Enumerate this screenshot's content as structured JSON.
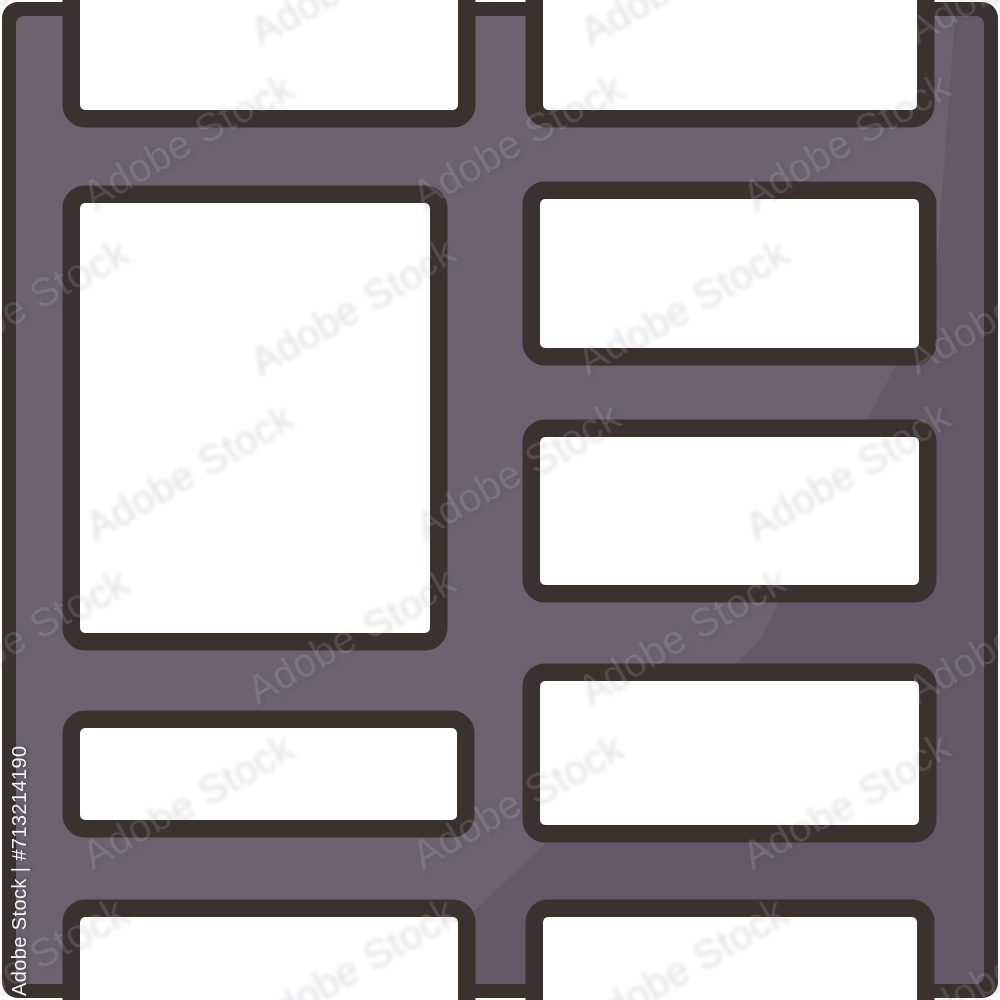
{
  "image": {
    "kind": "stock-icon-preview",
    "subject": "shelf / room divider flat icon with colored outline",
    "width": 1000,
    "height": 1000
  },
  "icon": {
    "colors": {
      "background": "#ffffff",
      "outline": "#3a322f",
      "fill": "#6b6470",
      "shade": "rgba(22,12,36,0.10)",
      "opening": "#ffffff"
    },
    "stroke_width": 17.5,
    "corner_radius": 14,
    "frame": {
      "x": 2,
      "y": 2,
      "w": 996,
      "h": 996,
      "rx": 16
    },
    "inner": {
      "x": 16,
      "y": 16,
      "w": 968,
      "h": 968,
      "rx": 8
    },
    "shade_path": "M955,16 L935,290 L862,430 L760,640 L380,1000 L984,1000 L984,16 Z",
    "openings": [
      {
        "name": "top-left-gap",
        "x": 80,
        "y": -30,
        "w": 378,
        "h": 140
      },
      {
        "name": "top-right-gap",
        "x": 543,
        "y": -30,
        "w": 374,
        "h": 140
      },
      {
        "name": "left-large",
        "x": 80,
        "y": 203,
        "w": 350,
        "h": 430
      },
      {
        "name": "left-small",
        "x": 80,
        "y": 728,
        "w": 377,
        "h": 92
      },
      {
        "name": "right-top",
        "x": 540,
        "y": 199,
        "w": 379,
        "h": 149
      },
      {
        "name": "right-middle",
        "x": 540,
        "y": 437,
        "w": 379,
        "h": 148
      },
      {
        "name": "right-bottom",
        "x": 540,
        "y": 681,
        "w": 379,
        "h": 144
      },
      {
        "name": "bottom-left-gap",
        "x": 80,
        "y": 917,
        "w": 378,
        "h": 118
      },
      {
        "name": "bottom-right-gap",
        "x": 543,
        "y": 917,
        "w": 374,
        "h": 118
      }
    ]
  },
  "watermark": {
    "tile_text": "Adobe Stock",
    "id_text": "Adobe Stock | #713214190",
    "stock_id": "#713214190",
    "grid": {
      "rows": 7,
      "cols": 4,
      "dx": 330,
      "dy": 165,
      "row_offset": 165,
      "x0": -90,
      "y0": 15,
      "angle_deg": -30,
      "font_size": 40
    }
  }
}
